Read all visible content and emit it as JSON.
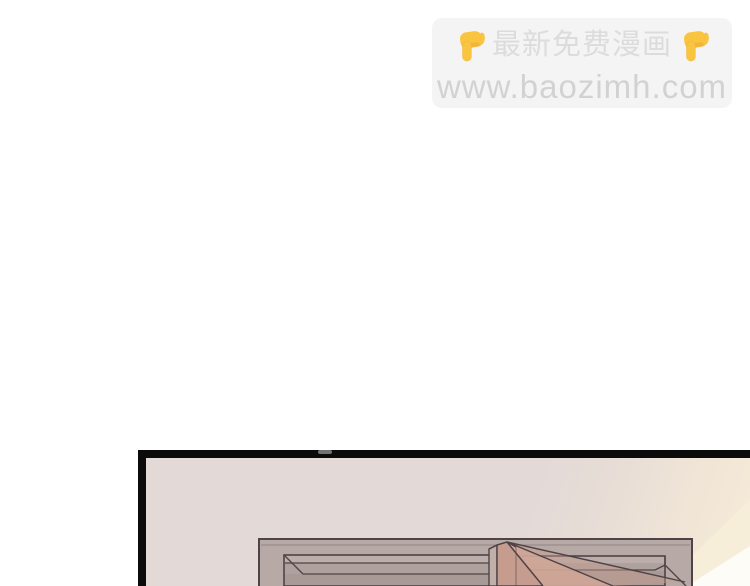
{
  "watermark": {
    "title": "最新免费漫画",
    "url": "www.baozimh.com",
    "left_icon": "pointing-down-emoji",
    "right_icon": "pointing-down-emoji"
  },
  "comic": {
    "panel_count_visible": 1,
    "panel_text": ""
  },
  "colors": {
    "wall": "#e3d9d7",
    "frame": "#b6a9a6",
    "door_pink": "#c59c8e",
    "light_cream": "#f7eed9",
    "panel_border": "#0b0b0b",
    "banner_bg": "#f4f4f5",
    "watermark_text": "#d2d2d2",
    "emoji_yellow": "#f9c440"
  }
}
